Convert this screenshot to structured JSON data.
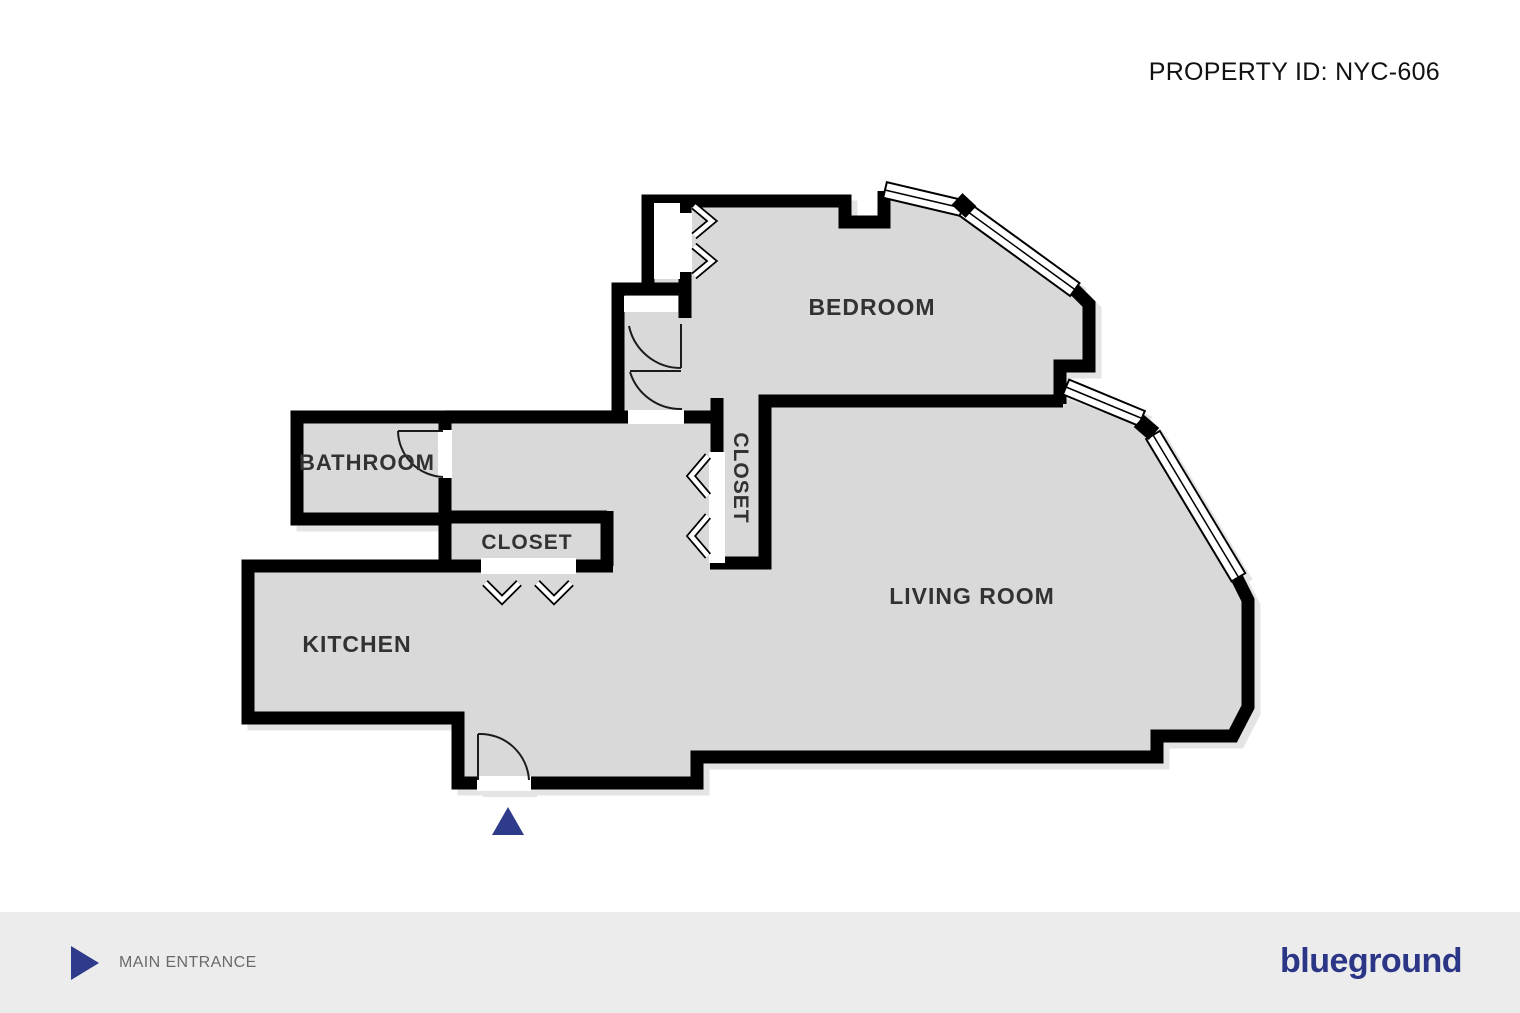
{
  "header": {
    "property_id_label": "PROPERTY ID: NYC-606"
  },
  "floorplan": {
    "rooms": [
      {
        "name": "bedroom",
        "label": "BEDROOM"
      },
      {
        "name": "living-room",
        "label": "LIVING ROOM"
      },
      {
        "name": "kitchen",
        "label": "KITCHEN"
      },
      {
        "name": "bathroom",
        "label": "BATHROOM"
      },
      {
        "name": "closet-hall",
        "label": "CLOSET"
      },
      {
        "name": "closet-living",
        "label": "CLOSET"
      }
    ],
    "features": {
      "windows_count": 4,
      "doors_count": 4,
      "entrance_marker": "blue-triangle"
    },
    "colors": {
      "wall": "#000000",
      "floor": "#d9d9d9",
      "label": "#333333",
      "accent_blue": "#2e3a8a",
      "shadow": "#e4e4e4"
    }
  },
  "footer": {
    "entrance_label": "MAIN ENTRANCE",
    "brand": "blueground",
    "background": "#ececec",
    "text_color": "#6a6a6a"
  }
}
